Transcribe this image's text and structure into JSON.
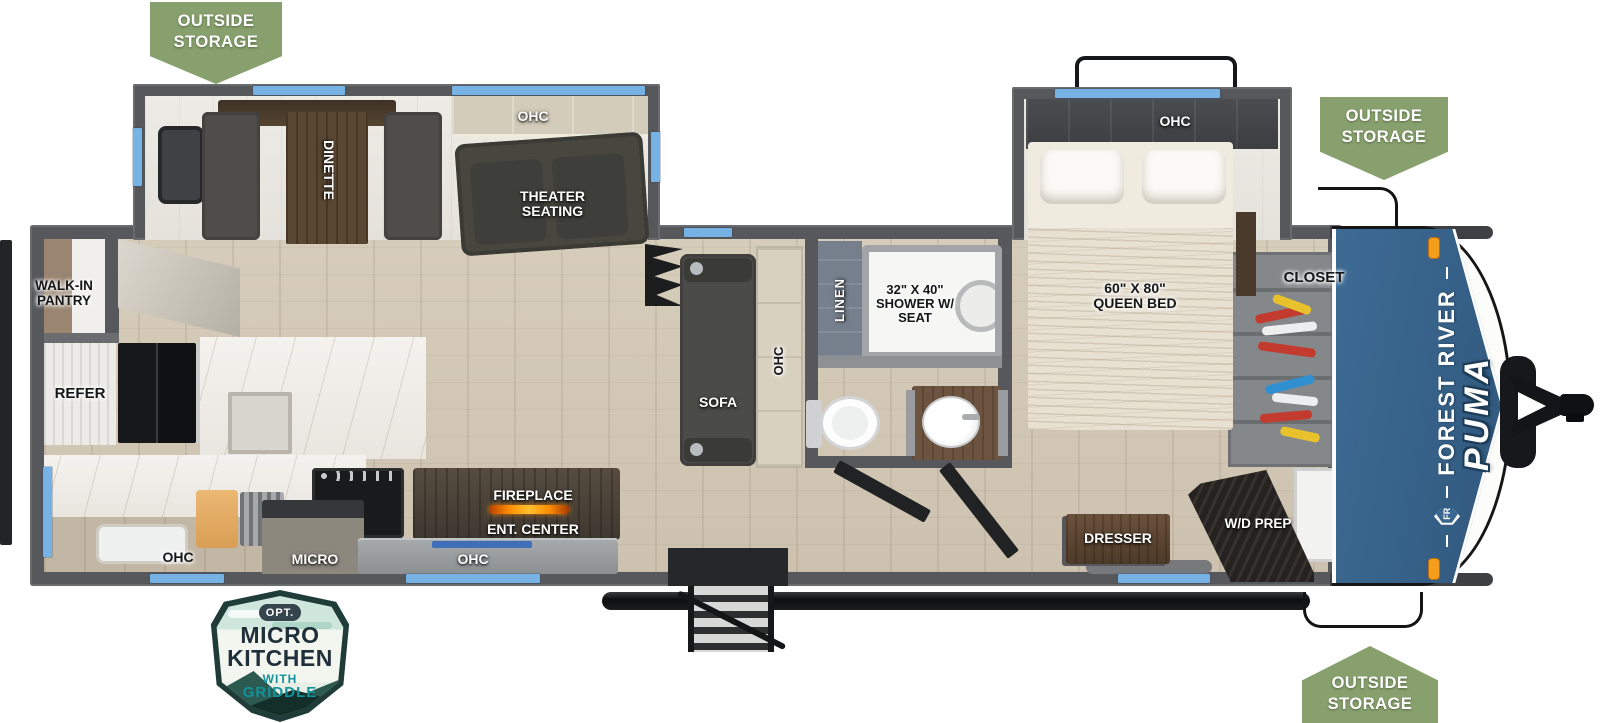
{
  "floorplan": {
    "badges": [
      {
        "position": "top-left",
        "text": "OUTSIDE STORAGE"
      },
      {
        "position": "top-right",
        "text": "OUTSIDE STORAGE"
      },
      {
        "position": "bottom-right",
        "text": "OUTSIDE STORAGE"
      }
    ],
    "option_badge": {
      "opt": "OPT.",
      "line1": "MICRO",
      "line2": "KITCHEN",
      "line3": "WITH",
      "line4": "GRIDDLE"
    },
    "brand": {
      "abbr": "FR",
      "name": "FOREST RIVER",
      "model": "PUMA"
    },
    "rooms": {
      "walk_in_pantry": "WALK-IN PANTRY",
      "refer": "REFER",
      "ohc_kitchen": "OHC",
      "micro": "MICRO",
      "ohc_galley": "OHC",
      "fireplace": "FIREPLACE",
      "ent_center": "ENT. CENTER",
      "dinette": "DINETTE",
      "ohc_theater": "OHC",
      "theater_seating": "THEATER SEATING",
      "sofa": "SOFA",
      "ohc_sofa": "OHC",
      "linen": "LINEN",
      "shower": "32\" X 40\" SHOWER W/ SEAT",
      "ohc_bedroom": "OHC",
      "queen_bed": "60\" X 80\" QUEEN BED",
      "closet": "CLOSET",
      "dresser": "DRESSER",
      "wd_prep": "W/D PREP"
    },
    "colors": {
      "badge_green": "#87a06d",
      "window_blue": "#76b2e4",
      "brand_blue": "#3a6790",
      "wall_gray": "#57585c",
      "flame_orange": "#ff8c00",
      "badge_teal": "#12929b"
    }
  }
}
